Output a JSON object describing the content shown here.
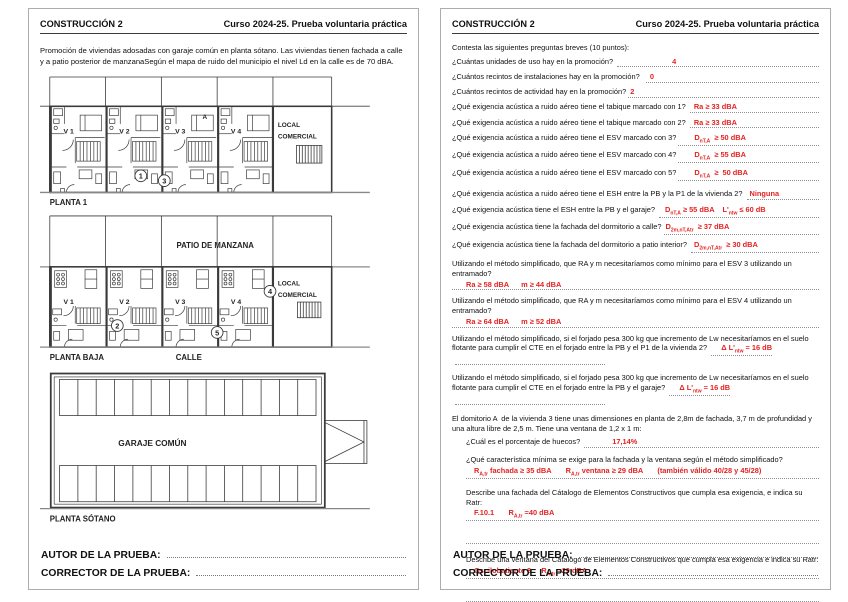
{
  "header": {
    "title": "CONSTRUCCIÓN 2",
    "course": "Curso 2024-25.  Prueba voluntaria práctica"
  },
  "footer": {
    "autor": "AUTOR DE LA PRUEBA:",
    "corrector": "CORRECTOR DE LA PRUEBA:"
  },
  "colors": {
    "answer_red": "#e42222",
    "plan_stroke": "#3a3a3a",
    "rule_gray": "#8f8f8f"
  },
  "page_left": {
    "intro": "Promoción de viviendas adosadas con garaje común en planta sótano. Las viviendas tienen fachada  a calle y a patio posterior de manzanaSegún el mapa de ruido del municipio el nivel Ld en la calle es de 70 dBA.",
    "plans": {
      "planta1": {
        "label": "PLANTA 1",
        "units": [
          "V 1",
          "V 2",
          "V 3",
          "V 4"
        ],
        "local_line1": "LOCAL",
        "local_line2": "COMERCIAL",
        "room_a": "A",
        "marker1": "1",
        "marker3": "3"
      },
      "planta_baja": {
        "label": "PLANTA BAJA",
        "patio": "PATIO DE MANZANA",
        "calle": "CALLE",
        "units": [
          "V 1",
          "V 2",
          "V 3",
          "V 4"
        ],
        "local_line1": "LOCAL",
        "local_line2": "COMERCIAL",
        "marker2": "2",
        "marker5": "5",
        "marker4": "4"
      },
      "sotano": {
        "label": "PLANTA SÓTANO",
        "garage": "GARAJE COMÚN"
      }
    }
  },
  "page_right": {
    "instructions": "Contesta las siguientes preguntas breves (10 puntos):",
    "questions": [
      {
        "t": "inline",
        "q": "¿Cuántas unidades de uso hay en la promoción? ",
        "a": "4",
        "pad": 55
      },
      {
        "t": "inline",
        "q": "¿Cuántos recintos de instalaciones hay en la promoción?  ",
        "a": "0",
        "pad": 4
      },
      {
        "t": "inline",
        "q": "¿Cuántos recintos de actividad hay en la promoción?",
        "a": "2",
        "pad": 2
      },
      {
        "t": "inline",
        "q": "¿Qué exigencia acústica a ruido aéreo tiene el tabique marcado con 1? ",
        "a": "Ra ≥ 33 dBA",
        "pad": 4
      },
      {
        "t": "inline",
        "q": "¿Qué exigencia acústica a ruido aéreo tiene el tabique marcado con 2? ",
        "a": "Ra ≥ 33 dBA",
        "pad": 4
      },
      {
        "t": "inline",
        "q": "¿Qué exigencia acústica a ruido aéreo tiene el ESV marcado con 3?",
        "a": "D_{nT,A}  ≥ 50 dBA",
        "pad": 16
      },
      {
        "t": "inline",
        "q": "¿Qué exigencia acústica a ruido aéreo tiene el ESV marcado con 4?",
        "a": "D_{nT,A}  ≥ 55 dBA",
        "pad": 16
      },
      {
        "t": "inline",
        "q": "¿Qué exigencia acústica a ruido aéreo tiene el ESV marcado con 5?",
        "a": "D_{nT,A}  ≥  50 dBA",
        "pad": 16
      },
      {
        "t": "inline",
        "q": "¿Qué exigencia acústica a ruido aéreo tiene el ESH entre la PB y la P1 de la vivienda 2? ",
        "a": "Ninguna",
        "pad": 3,
        "mt": 8
      },
      {
        "t": "inline",
        "q": "¿Qué exigencia acústica tiene el ESH entre la PB y el garaje? ",
        "a": "D_{nT,A} ≥ 55 dBA    L'_{ntw} ≤ 60 dB",
        "pad": 6,
        "mt": 5
      },
      {
        "t": "inline",
        "q": "¿Qué exigencia acústica tiene la fachada del dormitorio a calle?",
        "a": "D_{2m,nT,Atr}  ≥ 37 dBA",
        "pad": 2
      },
      {
        "t": "inline",
        "q": "¿Qué exigencia acústica tiene la fachada del dormitorio a patio interior? ",
        "a": "D_{2m,nT,Atr}  ≥ 30 dBA",
        "pad": 3
      },
      {
        "t": "block",
        "q": "Utilizando el método simplificado, que RA y m necesitaríamos como mínimo para el ESV 3 utilizando un entramado?",
        "a": "Ra ≥ 58 dBA      m ≥ 44 dBA",
        "pad": 14,
        "mt": 6
      },
      {
        "t": "block",
        "q": "Utilizando el método simplificado, que RA y m necesitaríamos como mínimo para el ESV 4 utilizando un entramado?",
        "a": "Ra ≥ 64 dBA      m ≥ 52 dBA",
        "pad": 14,
        "mt": 6
      },
      {
        "t": "wrap",
        "q": "Utilizando el método simplificado, si el forjado pesa 300 kg que incremento de Lw necesitaríamos en el suelo flotante para cumplir el CTE en el forjado entre la PB y el P1 de la vivienda 2?  ",
        "a": "Δ L'_{ntw} = 16 dB",
        "mt": 6
      },
      {
        "t": "wrap",
        "q": "Utilizando el método simplificado, si el forjado pesa 300 kg que incremento de Lw necesitaríamos en el suelo flotante para cumplir el CTE en el forjado entre la PB y el garaje?  ",
        "a": "Δ L'_{ntw} = 16 dB",
        "mt": 5
      },
      {
        "t": "text",
        "q": "El domitorio A  de la vivienda 3 tiene unas dimensiones en planta de 2,8m de fachada, 3,7 m de profundidad y una altura libre de 2,5 m. Tiene una ventana de 1,2 x 1 m:",
        "mt": 6
      },
      {
        "t": "inline",
        "q": "¿Cuál es el porcentaje de huecos? ",
        "a": "17,14%",
        "pad": 28,
        "ind": true,
        "mt": 4
      },
      {
        "t": "block",
        "q": "¿Qué característica mínima se exige para la fachada y la ventana según el método simplificado?",
        "a": "R_{A,tr} fachada ≥ 35 dBA       R_{A,tr} ventana ≥ 29 dBA       (también válido 40/28 y 45/28)",
        "pad": 8,
        "ind": true,
        "mt": 7
      },
      {
        "t": "block",
        "q": "Describe una fachada del Cátalogo de Elementos Constructivos que cumpla esa exigencia, e indica su Ratr:",
        "a": "F.10.1       R_{A,tr} =40 dBA",
        "pad": 8,
        "ind": true,
        "blank": true,
        "mt": 9
      },
      {
        "t": "block",
        "q": "Describe una ventana del Cátalogo de Elementos Constructivos que cumpla esa exigencia e indica su Ratr:",
        "a": "Oscilobatiente 8     R_{A,tr} =29 dBA",
        "pad": 8,
        "ind": true,
        "blank": true,
        "mt": 11
      }
    ]
  }
}
